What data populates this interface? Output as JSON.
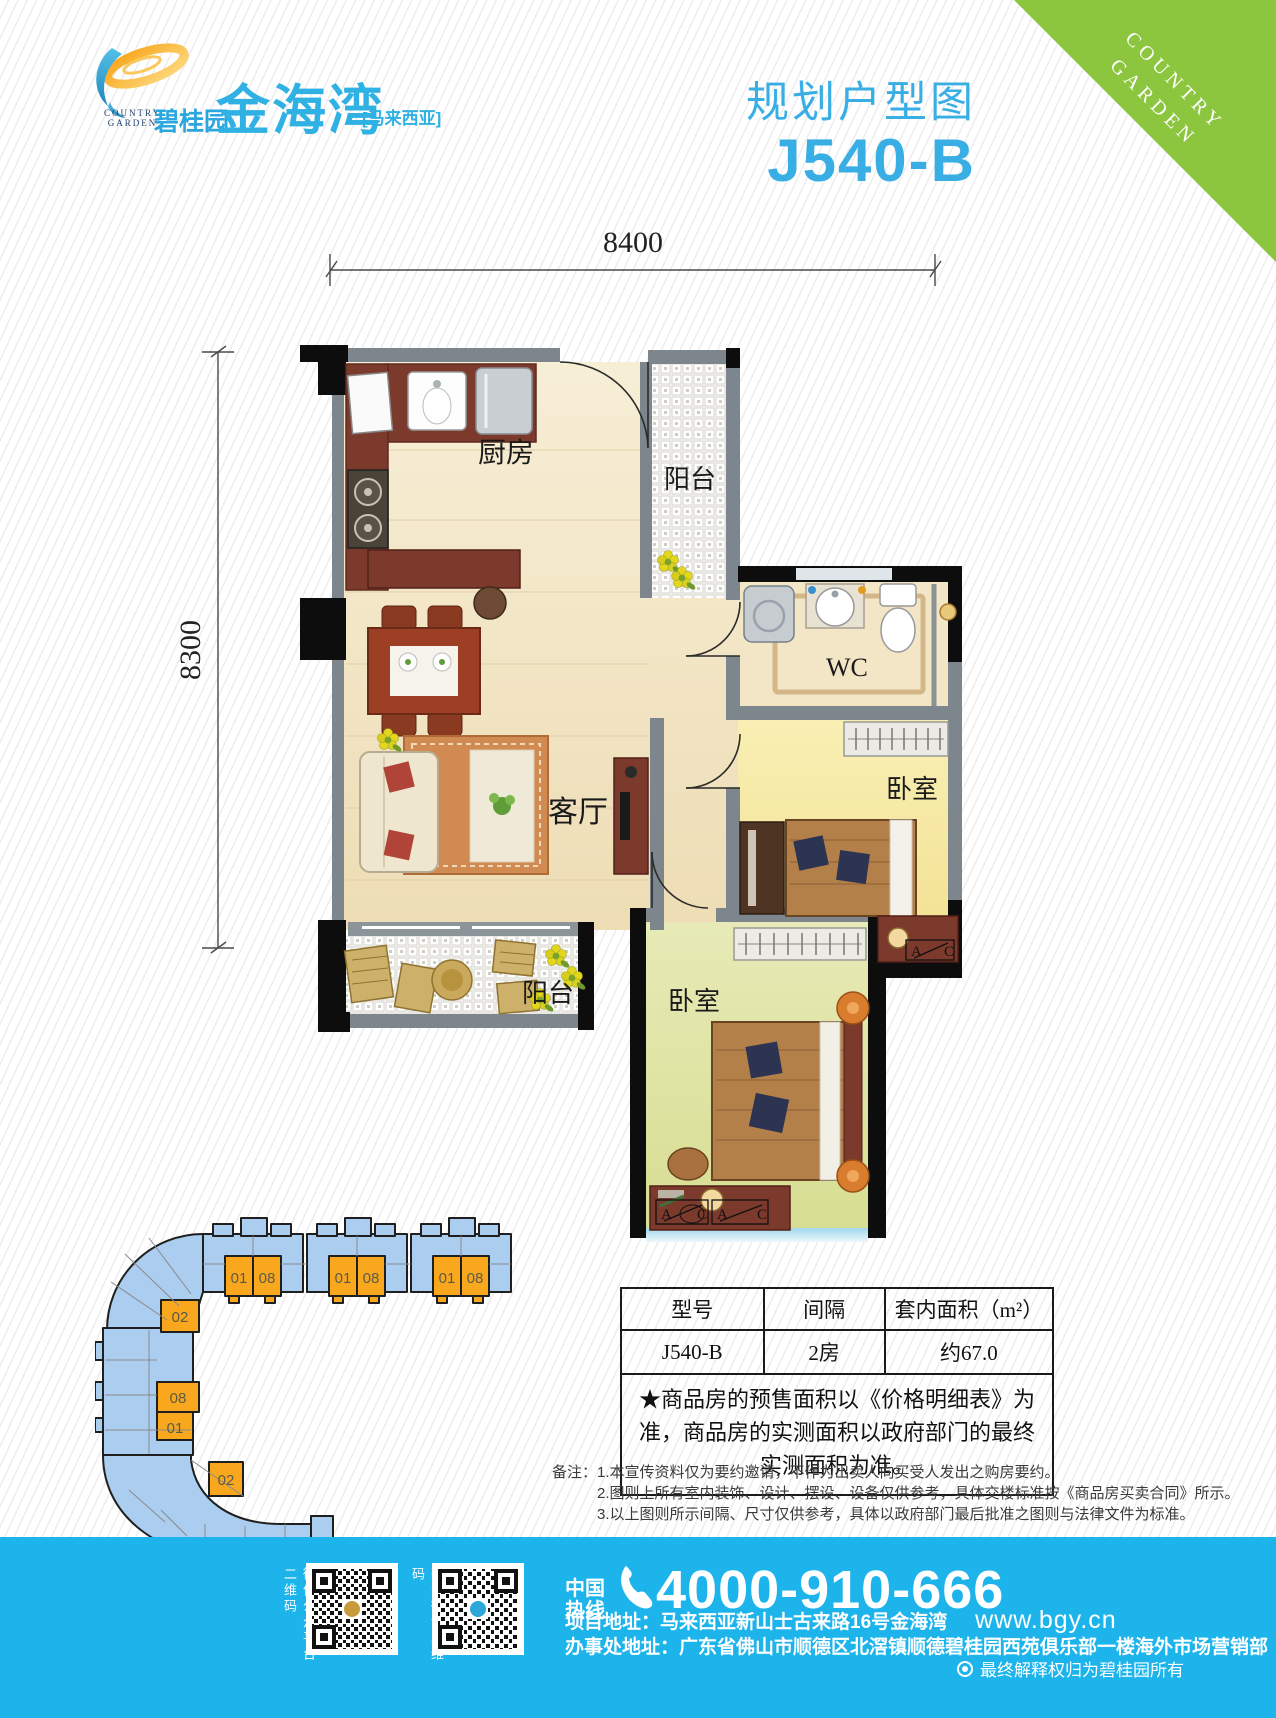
{
  "brand": {
    "logo_top": "COUNTRY",
    "logo_bottom": "GARDEN",
    "company_cn": "碧桂园",
    "project_cn": "金海湾",
    "region": "[马来西亚]"
  },
  "ribbon": {
    "line1": "COUNTRY",
    "line2": "GARDEN"
  },
  "header": {
    "title": "规划户型图",
    "unit_code": "J540-B"
  },
  "floorplan": {
    "dim_width": "8400",
    "dim_height": "8300",
    "labels": {
      "kitchen": "厨房",
      "balcony_top": "阳台",
      "wc": "WC",
      "living": "客厅",
      "bedroom_right": "卧室",
      "balcony_bottom": "阳台",
      "bedroom_bottom": "卧室"
    },
    "markers": {
      "a": "A",
      "c": "C"
    }
  },
  "siteplan": {
    "units": [
      "01",
      "08",
      "01",
      "08",
      "01",
      "08",
      "02",
      "08",
      "01",
      "02"
    ]
  },
  "spec_table": {
    "col_model": "型号",
    "col_layout": "间隔",
    "col_area": "套内面积（m²）",
    "model": "J540-B",
    "layout": "2房",
    "area": "约67.0",
    "note": "★商品房的预售面积以《价格明细表》为准，商品房的实测面积以政府部门的最终实测面积为准。"
  },
  "remarks": {
    "label": "备注：",
    "line1": "1.本宣传资料仅为要约邀请，不作为出卖人向买受人发出之购房要约。",
    "line2": "2.图则上所有室内装饰、设计、摆设、设备仅供参考，具体交楼标准按《商品房买卖合同》所示。",
    "line3": "3.以上图则所示间隔、尺寸仅供参考，具体以政府部门最后批准之图则与法律文件为标准。"
  },
  "footer": {
    "qr_wechat_label": "微信公众平台二维码",
    "qr_weibo_label": "新浪微博二维码",
    "hotline_cn1": "中国",
    "hotline_cn2": "热线",
    "phone": "4000-910-666",
    "address_project": "项目地址：马来西亚新山士古来路16号金海湾",
    "website": "www.bgy.cn",
    "address_office": "办事处地址：广东省佛山市顺德区北滘镇顺德碧桂园西苑俱乐部一楼海外市场营销部",
    "disclaimer": "最终解释权归为碧桂园所有"
  },
  "colors": {
    "accent_blue": "#38aee4",
    "ribbon_green": "#8cc63e",
    "footer_blue": "#1db4ec",
    "site_blue": "#aacdf0",
    "site_orange": "#f9a71c"
  }
}
